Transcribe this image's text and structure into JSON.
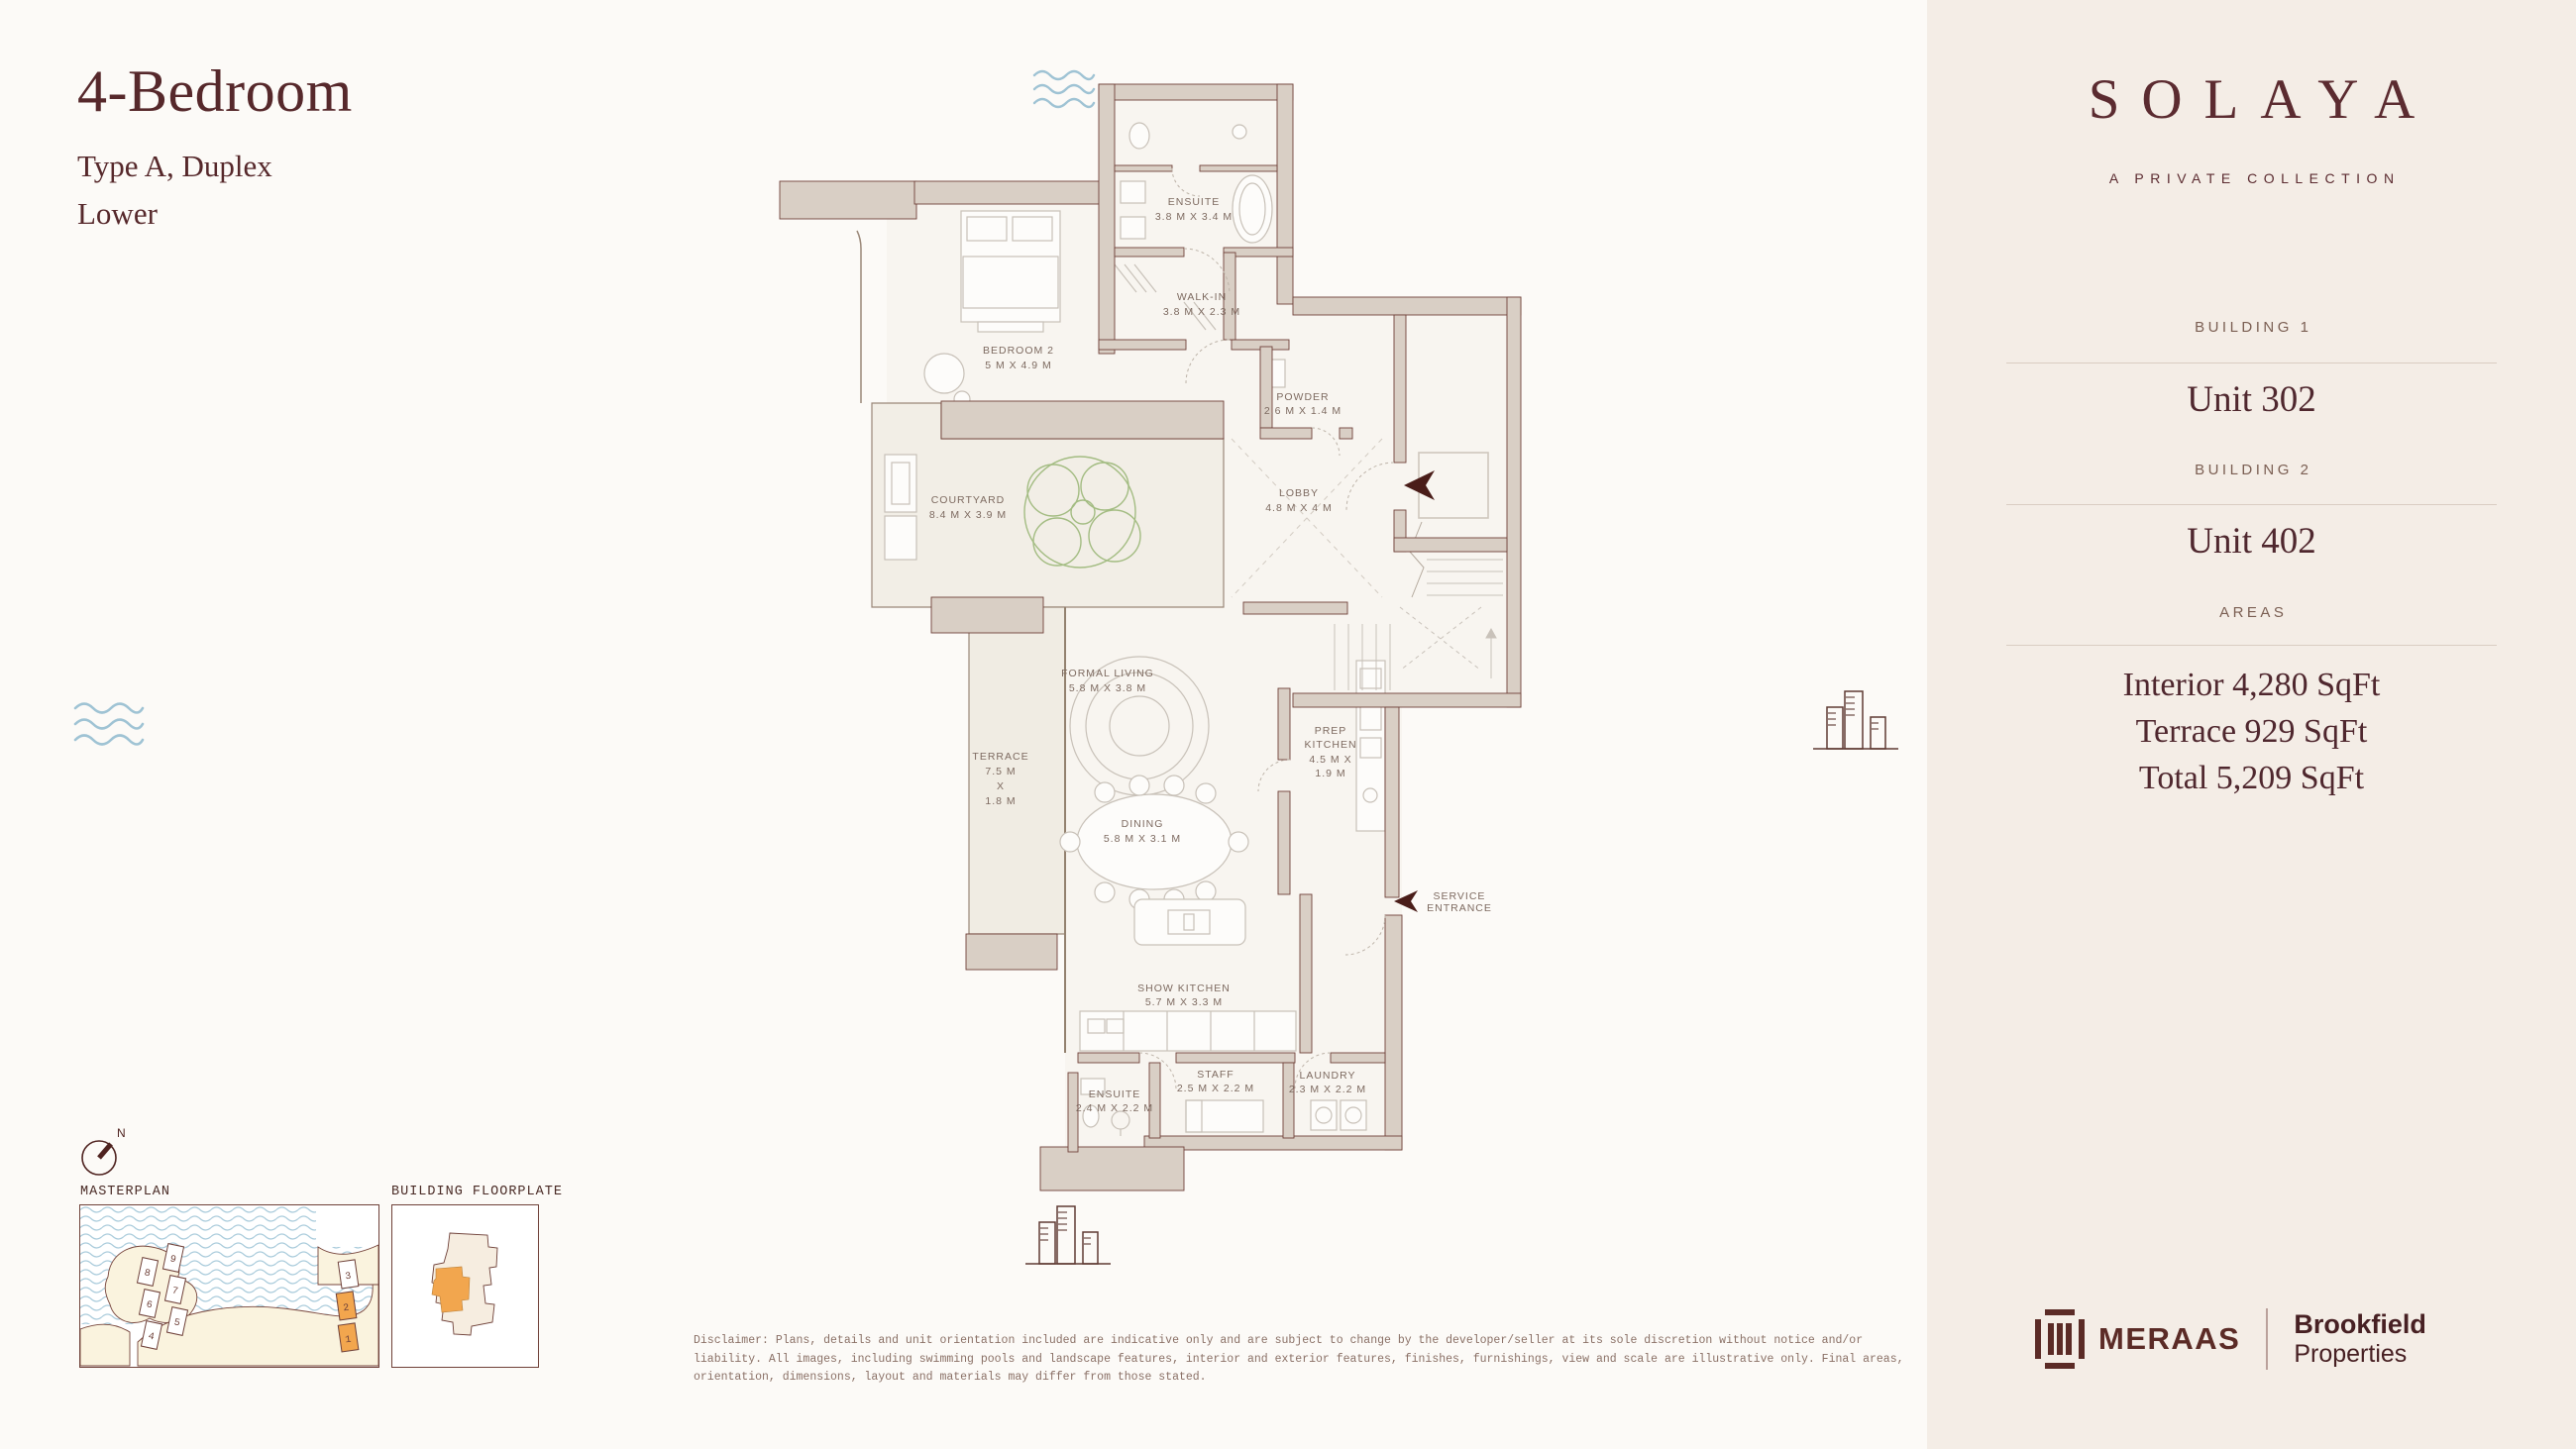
{
  "header": {
    "title": "4-Bedroom",
    "subtitle": "Type A, Duplex",
    "floor": "Lower"
  },
  "sidebar": {
    "brand": "SOLAYA",
    "tagline": "A PRIVATE COLLECTION",
    "building1_label": "BUILDING 1",
    "building1_unit": "Unit 302",
    "building2_label": "BUILDING 2",
    "building2_unit": "Unit 402",
    "areas_label": "AREAS",
    "area_lines": [
      "Interior 4,280 SqFt",
      "Terrace 929 SqFt",
      "Total 5,209 SqFt"
    ],
    "developer": "MERAAS",
    "partner_line1": "Brookfield",
    "partner_line2": "Properties"
  },
  "plan": {
    "rooms": [
      {
        "id": "ensuite-upper",
        "lines": [
          "ENSUITE",
          "3.8 M X 3.4 M"
        ]
      },
      {
        "id": "walk-in",
        "lines": [
          "WALK-IN",
          "3.8 M X 2.3 M"
        ]
      },
      {
        "id": "bedroom-2",
        "lines": [
          "BEDROOM 2",
          "5 M X 4.9 M"
        ]
      },
      {
        "id": "powder",
        "lines": [
          "POWDER",
          "2.6 M X 1.4 M"
        ]
      },
      {
        "id": "courtyard",
        "lines": [
          "COURTYARD",
          "8.4 M X 3.9 M"
        ]
      },
      {
        "id": "lobby",
        "lines": [
          "LOBBY",
          "4.8 M X 4 M"
        ]
      },
      {
        "id": "formal-living",
        "lines": [
          "FORMAL LIVING",
          "5.8 M X 3.8 M"
        ]
      },
      {
        "id": "terrace",
        "lines": [
          "TERRACE",
          "7.5 M",
          "X",
          "1.8 M"
        ]
      },
      {
        "id": "prep-kitchen",
        "lines": [
          "PREP",
          "KITCHEN",
          "4.5 M X",
          "1.9 M"
        ]
      },
      {
        "id": "dining",
        "lines": [
          "DINING",
          "5.8 M X 3.1 M"
        ]
      },
      {
        "id": "show-kitchen",
        "lines": [
          "SHOW KITCHEN",
          "5.7 M X 3.3 M"
        ]
      },
      {
        "id": "staff",
        "lines": [
          "STAFF",
          "2.5 M X 2.2 M"
        ]
      },
      {
        "id": "laundry",
        "lines": [
          "LAUNDRY",
          "2.3 M X 2.2 M"
        ]
      },
      {
        "id": "ensuite-lower",
        "lines": [
          "ENSUITE",
          "2.4 M X 2.2 M"
        ]
      }
    ],
    "service_entrance": [
      "SERVICE",
      "ENTRANCE"
    ]
  },
  "minimaps": {
    "compass_label": "N",
    "masterplan_label": "MASTERPLAN",
    "floorplate_label": "BUILDING FLOORPLATE",
    "masterplan_buildings": [
      {
        "n": "8",
        "highlight": false
      },
      {
        "n": "6",
        "highlight": false
      },
      {
        "n": "4",
        "highlight": false
      },
      {
        "n": "9",
        "highlight": false
      },
      {
        "n": "7",
        "highlight": false
      },
      {
        "n": "5",
        "highlight": false
      },
      {
        "n": "3",
        "highlight": false
      },
      {
        "n": "2",
        "highlight": true
      },
      {
        "n": "1",
        "highlight": true
      }
    ]
  },
  "disclaimer": "Disclaimer: Plans, details and unit orientation included are indicative only and are subject to change by the developer/seller at its sole discretion without notice and/or liability. All images, including swimming pools and landscape features, interior and exterior features, finishes, furnishings, view and scale are illustrative only. Final areas, orientation, dimensions, layout and materials may differ from those stated.",
  "colors": {
    "accent_maroon": "#5B2B2C",
    "wall_fill": "#D9CFC5",
    "wall_line": "#6F4139",
    "orange_highlight": "#F2A64E",
    "water_blue": "#9FC3D4",
    "land_cream": "#FAF3DE"
  }
}
